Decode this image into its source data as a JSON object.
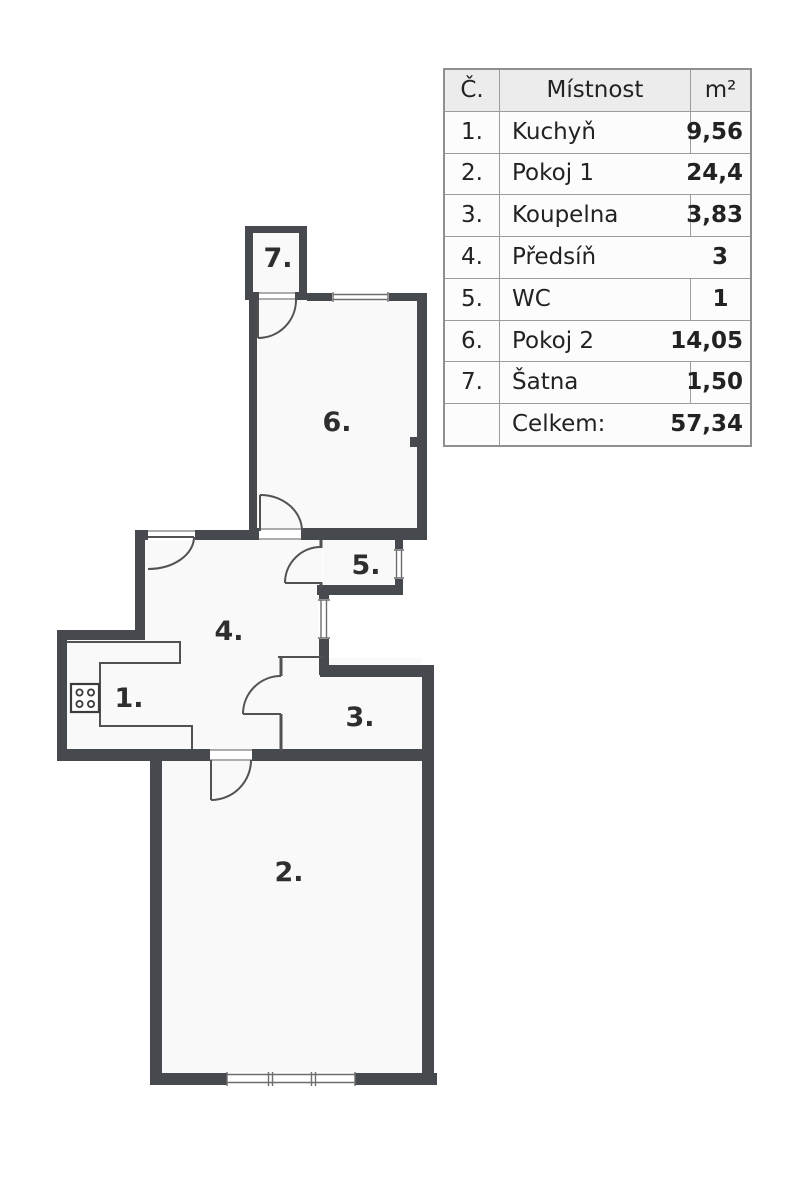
{
  "floor_plan": {
    "room_labels": {
      "r1": "1.",
      "r2": "2.",
      "r3": "3.",
      "r4": "4.",
      "r5": "5.",
      "r6": "6.",
      "r7": "7."
    },
    "icons": {
      "stove": "stove-icon"
    },
    "colors": {
      "wall": "#46494e",
      "line": "#515151",
      "room_fill": "#f9f9f9",
      "background": "#ffffff"
    }
  },
  "table": {
    "header": {
      "number": "Č.",
      "room": "Místnost",
      "area": "m²"
    },
    "rows": [
      {
        "number": "1.",
        "name": "Kuchyň",
        "area": "9,56"
      },
      {
        "number": "2.",
        "name": "Pokoj 1",
        "area": "24,4"
      },
      {
        "number": "3.",
        "name": "Koupelna",
        "area": "3,83"
      },
      {
        "number": "4.",
        "name": "Předsíň",
        "area": "3"
      },
      {
        "number": "5.",
        "name": "WC",
        "area": "1"
      },
      {
        "number": "6.",
        "name": "Pokoj 2",
        "area": "14,05"
      },
      {
        "number": "7.",
        "name": "Šatna",
        "area": "1,50"
      },
      {
        "number": "",
        "name": "Celkem:",
        "area": "57,34"
      }
    ],
    "colors": {
      "border": "#9c9c9c",
      "header_bg": "#ececec",
      "text": "#222222"
    }
  }
}
